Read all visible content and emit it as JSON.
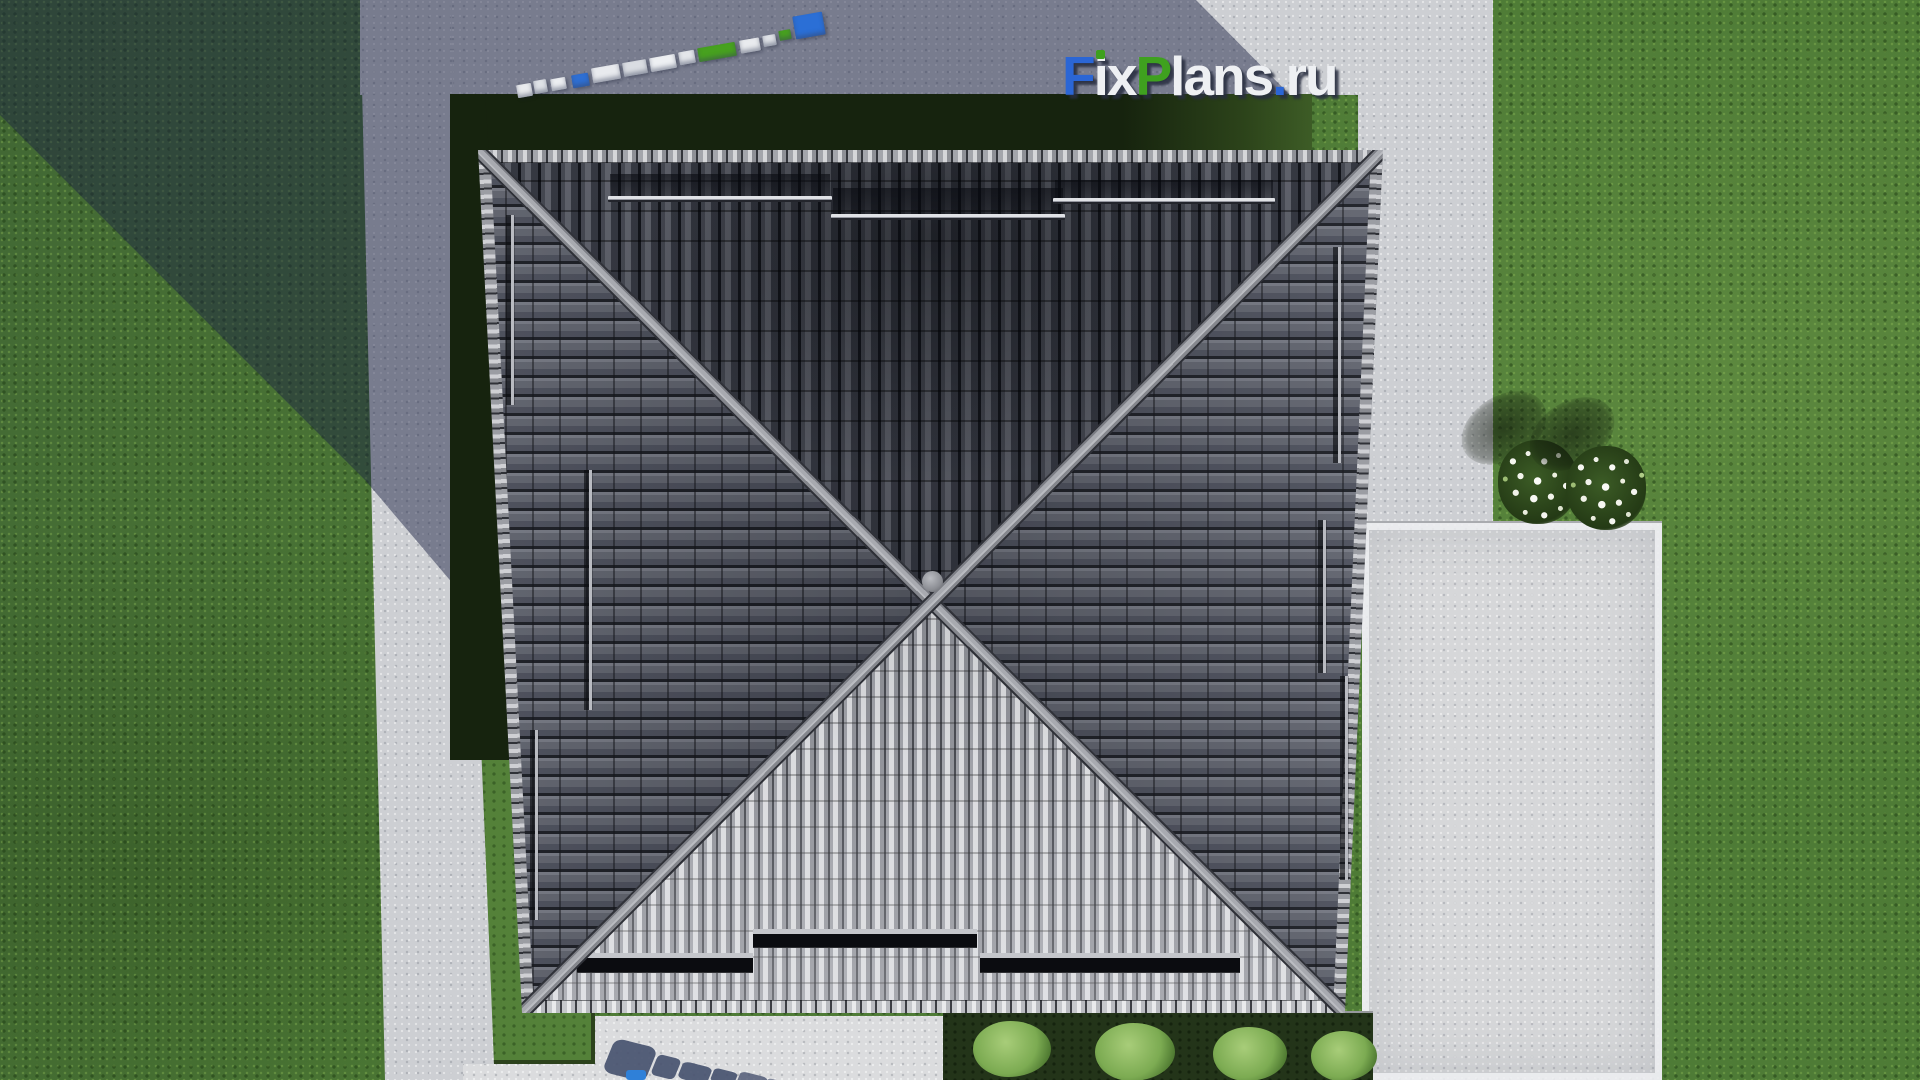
{
  "watermark": {
    "text": "FixPlans.ru",
    "letters": [
      {
        "text": "F",
        "color": "#2b66d5"
      },
      {
        "text": "i",
        "color": "#eef0f3"
      },
      {
        "text": "x",
        "color": "#eef0f3"
      },
      {
        "text": "P",
        "color": "#3fa11f"
      },
      {
        "text": "l",
        "color": "#eef0f3"
      },
      {
        "text": "a",
        "color": "#eef0f3"
      },
      {
        "text": "n",
        "color": "#eef0f3"
      },
      {
        "text": "s",
        "color": "#eef0f3"
      },
      {
        "text": ".",
        "color": "#2b66d5"
      },
      {
        "text": "r",
        "color": "#eef0f3"
      },
      {
        "text": "u",
        "color": "#eef0f3"
      }
    ],
    "accent_blue": "#2b66d5",
    "accent_green": "#3fa11f",
    "text_white": "#eef0f3"
  },
  "scene": {
    "description": "aerial top-down 3D render of a square hip roof house with X ridge, concrete paths, lawn, flower bushes and garden bed",
    "roof_tile_color": "#565963",
    "roof_bottom_face_highlight": "#d8d9dc",
    "ridge_color": "#a8aab0",
    "grass_color": "#4e7b36",
    "dark_grass_shadow_color": "#16230e",
    "pavement_color": "#cdcfd3",
    "pad_color": "#d6d7d9",
    "cast_shadow_color": "rgba(28,34,66,0.48)",
    "scalebar_blocks": [
      {
        "x": 517,
        "y": 84,
        "w": 15,
        "h": 13,
        "bg": "#e9ebee"
      },
      {
        "x": 534,
        "y": 80,
        "w": 13,
        "h": 13,
        "bg": "#dfe2e7"
      },
      {
        "x": 551,
        "y": 78,
        "w": 15,
        "h": 12,
        "bg": "#eceef1"
      },
      {
        "x": 572,
        "y": 74,
        "w": 17,
        "h": 13,
        "bg": "#2e6fd3"
      },
      {
        "x": 592,
        "y": 66,
        "w": 28,
        "h": 15,
        "bg": "#e8eaee"
      },
      {
        "x": 623,
        "y": 61,
        "w": 24,
        "h": 14,
        "bg": "#dadde2"
      },
      {
        "x": 650,
        "y": 56,
        "w": 26,
        "h": 14,
        "bg": "#eef0f3"
      },
      {
        "x": 679,
        "y": 51,
        "w": 16,
        "h": 13,
        "bg": "#e4e6ea"
      },
      {
        "x": 698,
        "y": 45,
        "w": 38,
        "h": 14,
        "bg": "#47a11f"
      },
      {
        "x": 740,
        "y": 39,
        "w": 20,
        "h": 13,
        "bg": "#e9ebee"
      },
      {
        "x": 763,
        "y": 35,
        "w": 13,
        "h": 11,
        "bg": "#dfe2e7"
      },
      {
        "x": 779,
        "y": 30,
        "w": 12,
        "h": 10,
        "bg": "#47a11f"
      },
      {
        "x": 794,
        "y": 14,
        "w": 30,
        "h": 23,
        "bg": "#2b6fd6"
      }
    ],
    "garden_bushes": [
      {
        "x": 30,
        "y": 8,
        "w": 78,
        "h": 56
      },
      {
        "x": 152,
        "y": 10,
        "w": 80,
        "h": 58
      },
      {
        "x": 270,
        "y": 14,
        "w": 74,
        "h": 54
      },
      {
        "x": 368,
        "y": 18,
        "w": 66,
        "h": 50
      }
    ]
  }
}
